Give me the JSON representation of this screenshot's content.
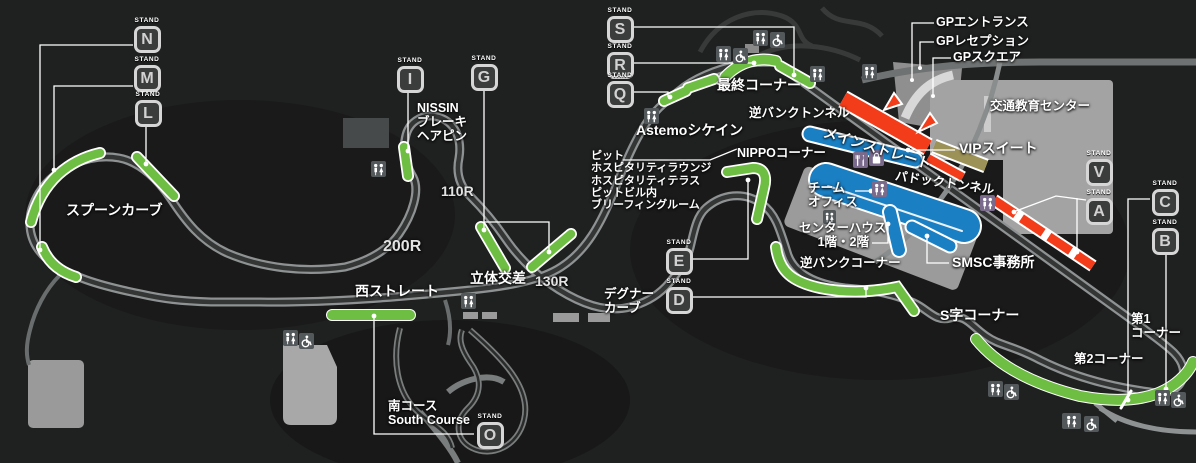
{
  "stands": {
    "caption": "STAND",
    "letters": {
      "N": "N",
      "M": "M",
      "L": "L",
      "I": "I",
      "G": "G",
      "S": "S",
      "R": "R",
      "Q": "Q",
      "E": "E",
      "D": "D",
      "O": "O",
      "V": "V",
      "A": "A",
      "C": "C",
      "B": "B"
    }
  },
  "labels": {
    "spoon_curve": "スプーンカーブ",
    "nissin": [
      "NISSIN",
      "ブレーキ",
      "ヘアピン"
    ],
    "r110": "110R",
    "r200": "200R",
    "r130": "130R",
    "crossover": "立体交差",
    "west_straight": "西ストレート",
    "degner": [
      "デグナー",
      "カーブ"
    ],
    "astemo": "Astemoシケイン",
    "final_corner": "最終コーナー",
    "reverse_bank_tunnel": "逆バンクトンネル",
    "nippo": "NIPPOコーナー",
    "pit_block": [
      "ピット",
      "ホスピタリティラウンジ",
      "ホスピタリティテラス",
      "ピットビル内",
      "ブリーフィングルーム"
    ],
    "main_straight": "メインストレート",
    "vip_suite": "VIPスイート",
    "paddock_tunnel": "パドックトンネル",
    "team_office": [
      "チーム",
      "オフィス"
    ],
    "center_house": [
      "センターハウス",
      "1階・2階"
    ],
    "reverse_bank_corner": "逆バンクコーナー",
    "smsc_office": "SMSC事務所",
    "s_curves": "S字コーナー",
    "corner1": [
      "第1",
      "コーナー"
    ],
    "corner2": "第2コーナー",
    "south_course": [
      "南コース",
      "South Course"
    ],
    "gp_entrance": "GPエントランス",
    "gp_reception": "GPレセプション",
    "gp_square": "GPスクエア",
    "traffic_center": "交通教育センター"
  },
  "icon_names": [
    "toilet-icon",
    "wheelchair-icon",
    "restaurant-icon",
    "shop-icon"
  ],
  "colors": {
    "background": "#1f2020",
    "stand_green": "#6fbe44",
    "straight_orange": "#f23c1a",
    "grandstand_blue": "#1b7fc3",
    "vip_khaki": "#9c9156",
    "track_gray": "#8f9293",
    "leader_white": "#ffffff"
  }
}
